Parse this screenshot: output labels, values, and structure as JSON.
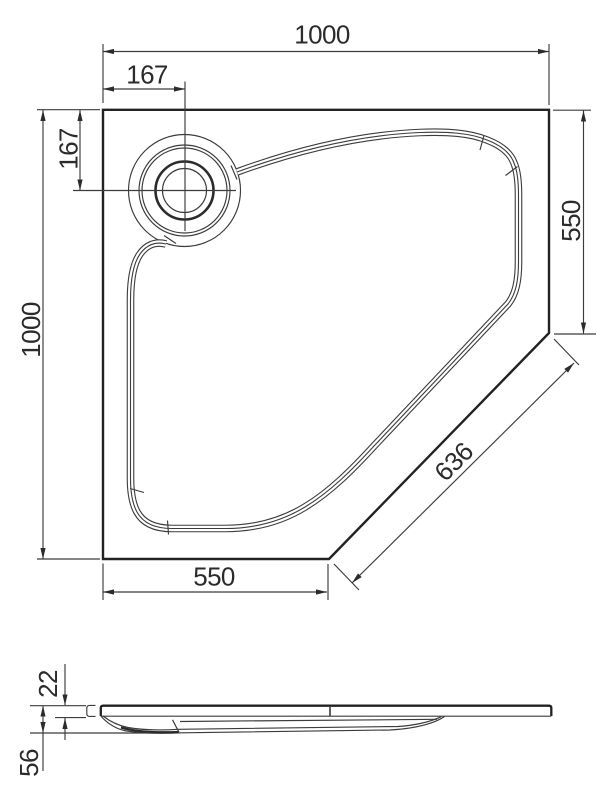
{
  "drawing": {
    "title": "shower-tray-dimension-drawing",
    "plan": {
      "top_width": "1000",
      "drain_offset_horizontal": "167",
      "drain_offset_vertical": "167",
      "left_height": "1000",
      "right_side": "550",
      "diagonal_front": "636",
      "bottom_side": "550"
    },
    "side": {
      "rim_thickness": "22",
      "overall_height": "56"
    },
    "colors": {
      "line": "#3c3c3c",
      "heavy": "#222222",
      "ink": "#2b2b2b",
      "background": "#ffffff"
    }
  }
}
